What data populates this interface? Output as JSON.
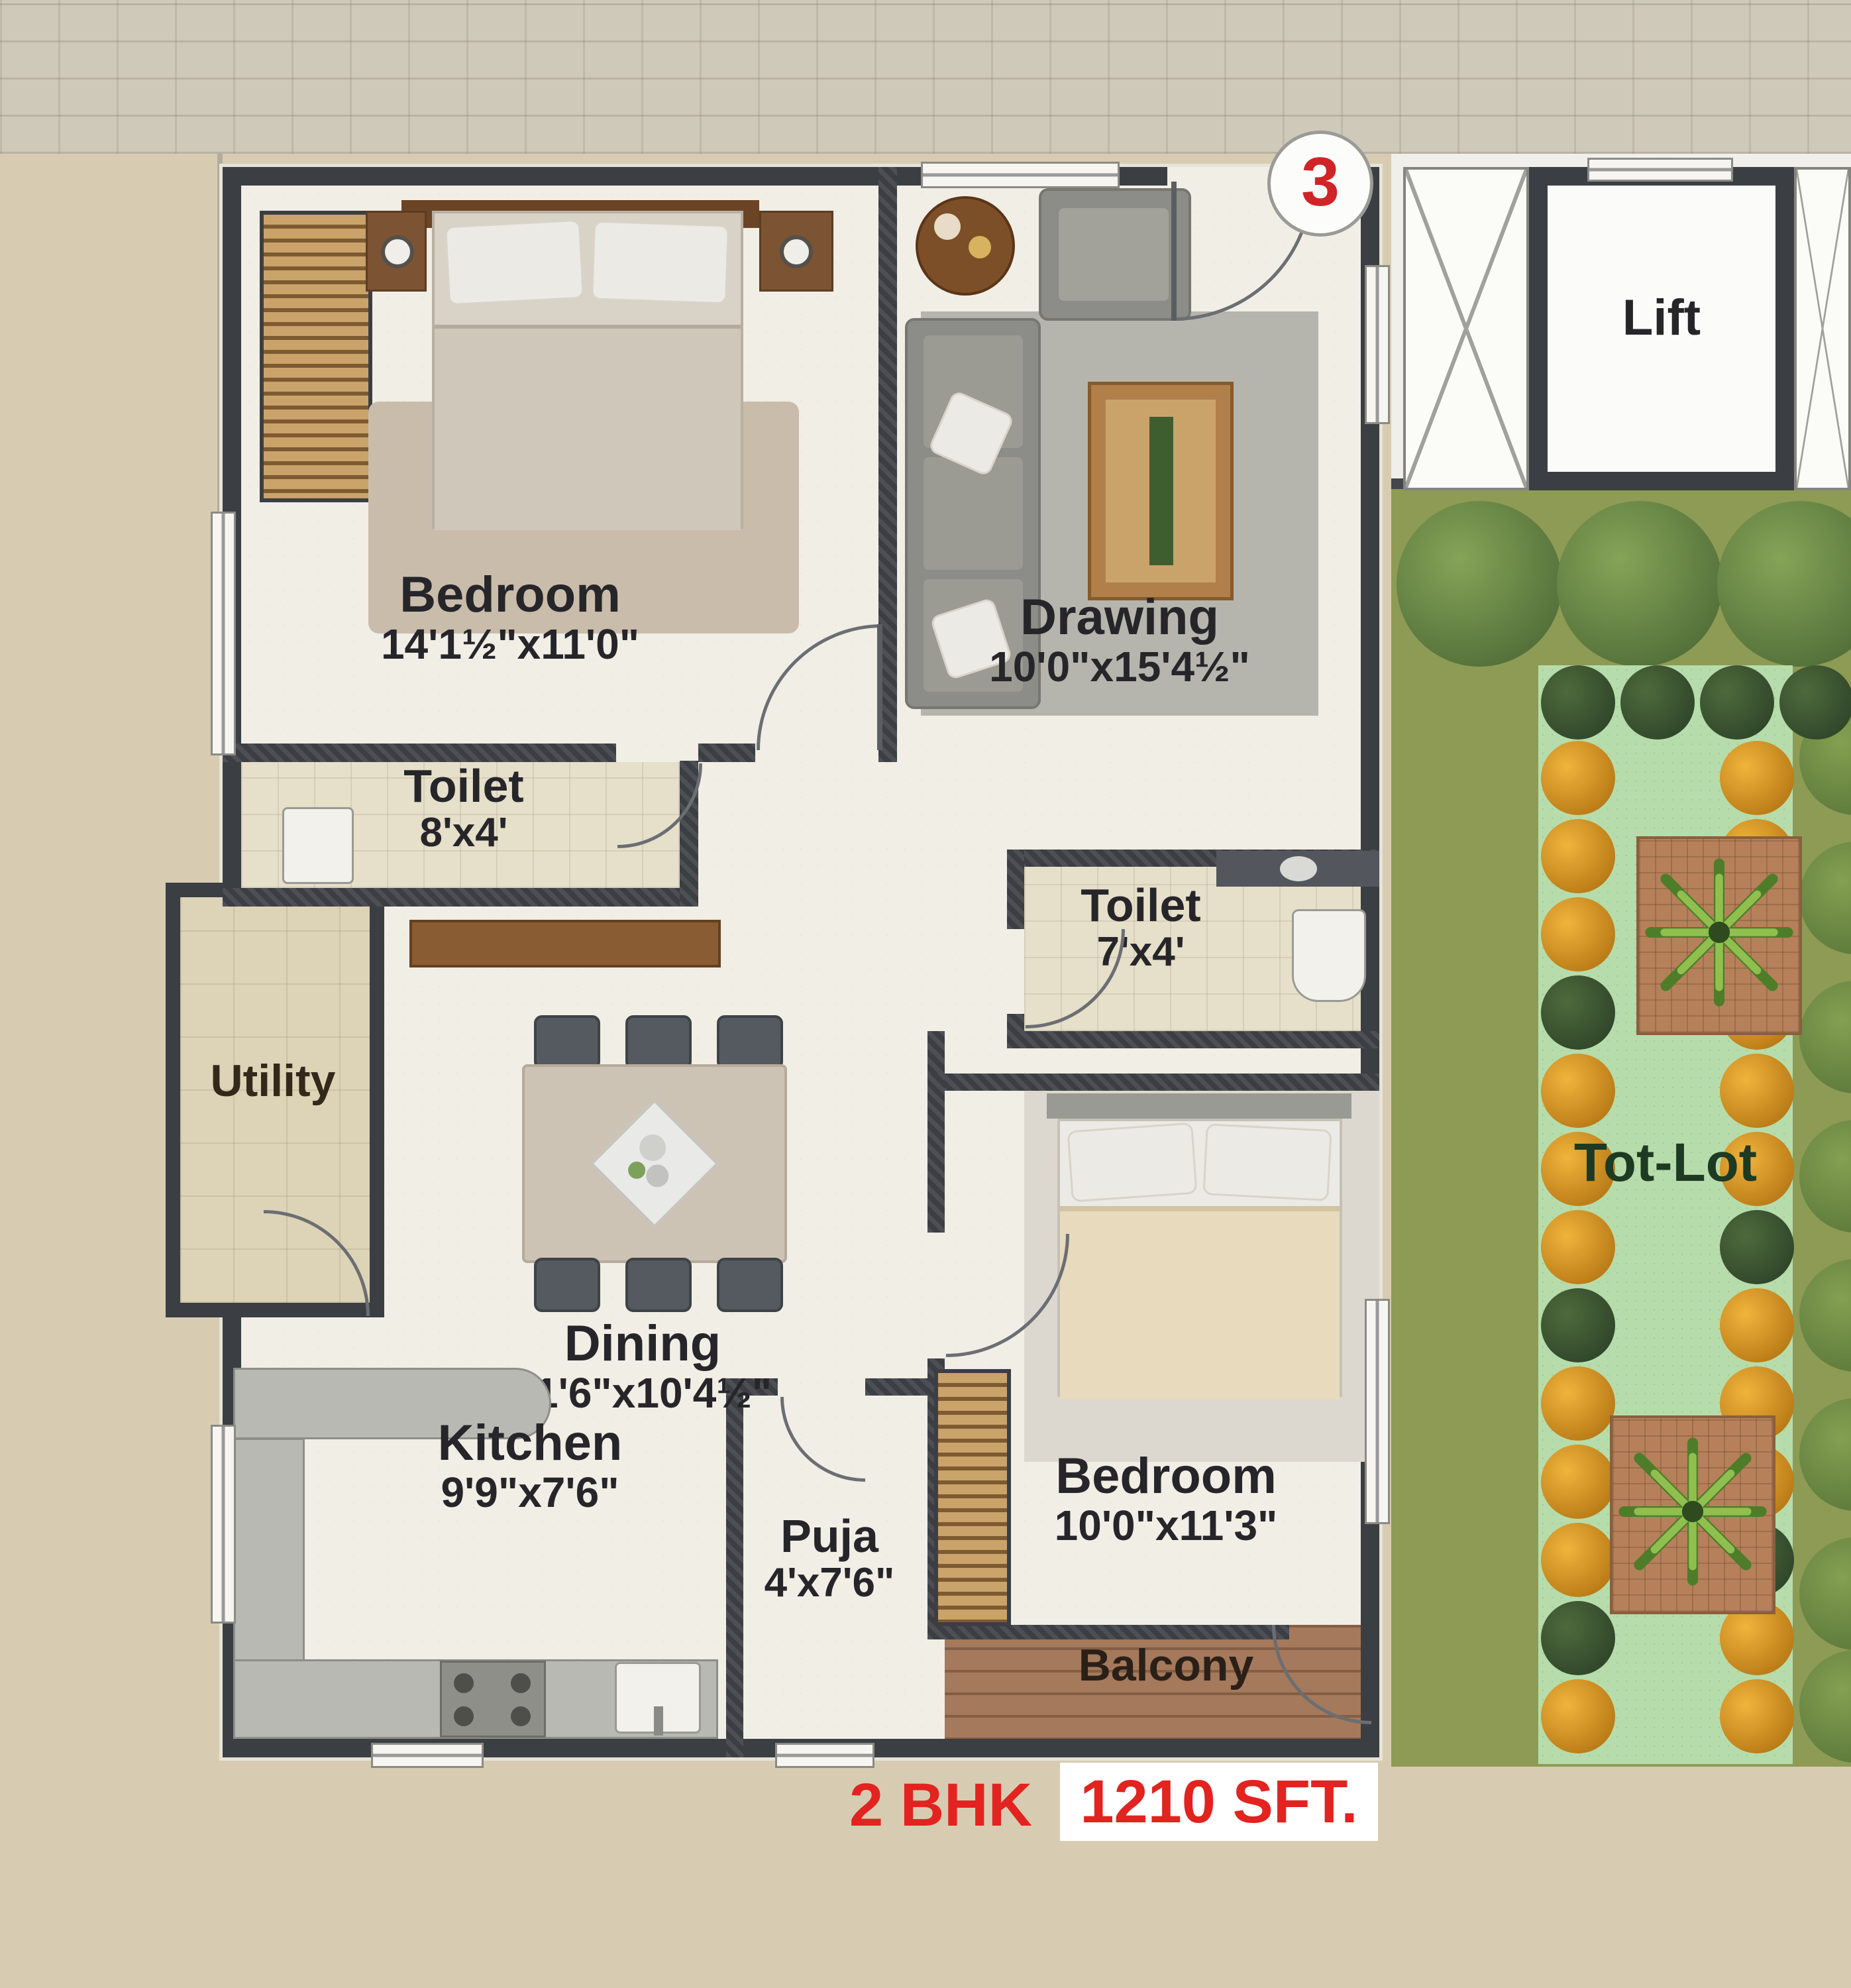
{
  "unit_marker": "3",
  "rooms": {
    "bedroom1": {
      "name": "Bedroom",
      "dims": "14'1½\"x11'0\""
    },
    "toilet1": {
      "name": "Toilet",
      "dims": "8'x4'"
    },
    "drawing": {
      "name": "Drawing",
      "dims": "10'0\"x15'4½\""
    },
    "toilet2": {
      "name": "Toilet",
      "dims": "7'x4'"
    },
    "utility": {
      "name": "Utility"
    },
    "dining": {
      "name": "Dining",
      "dims": "11'6\"x10'4½\""
    },
    "kitchen": {
      "name": "Kitchen",
      "dims": "9'9\"x7'6\""
    },
    "puja": {
      "name": "Puja",
      "dims": "4'x7'6\""
    },
    "bedroom2": {
      "name": "Bedroom",
      "dims": "10'0\"x11'3\""
    },
    "balcony": {
      "name": "Balcony"
    },
    "lift": {
      "name": "Lift"
    },
    "tot_lot": {
      "name": "Tot-Lot"
    }
  },
  "footer": {
    "bhk": "2 BHK",
    "area": "1210 SFT."
  },
  "colors": {
    "wall": "#3b3e43",
    "accent_red": "#e2231f",
    "lawn": "#b7dcab",
    "olive": "#8e9b55"
  }
}
